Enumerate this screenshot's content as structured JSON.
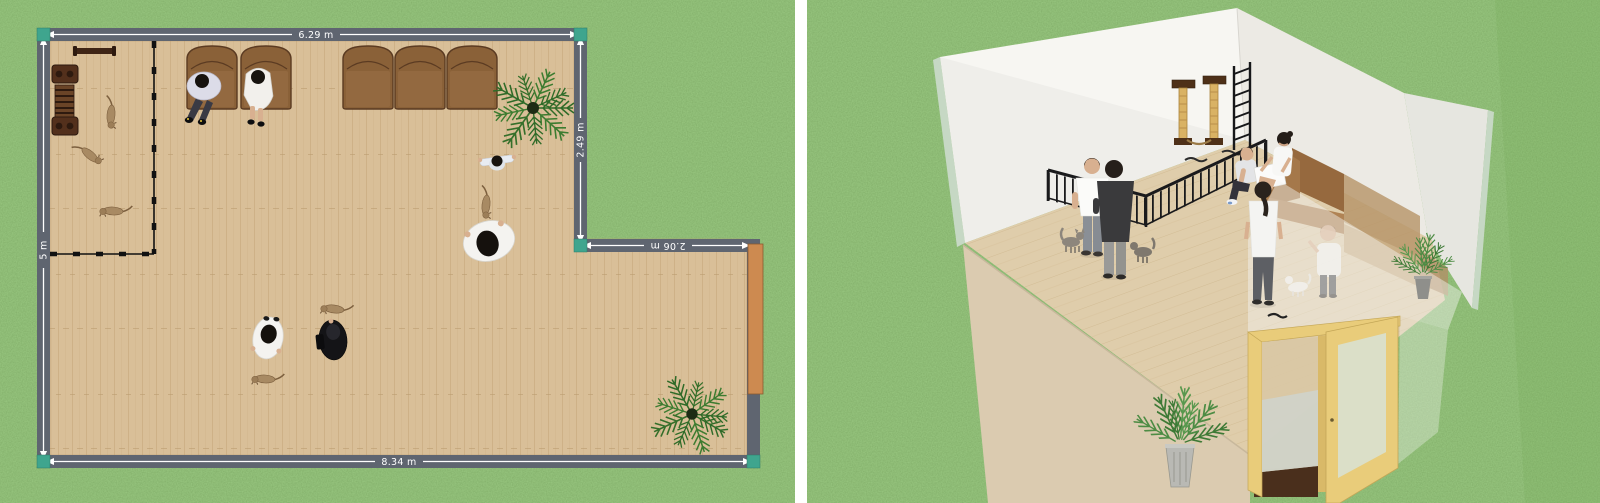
{
  "plan2d": {
    "dimensions": {
      "top": "6.29 m",
      "right": "2.49 m",
      "step": "2.06 m",
      "bottom": "8.34 m",
      "left": "5 m"
    }
  },
  "colors": {
    "grass": "#4e8a38",
    "divider": "#ffffff",
    "wall_band": "#5f6570",
    "dim_text": "#ffffff",
    "corner_accent": "#3fa58e",
    "floor": "#d9bf98",
    "plank_line": "#c9ab80",
    "sofa": "#8a6138",
    "sofa_seat": "#946a41",
    "sofa_outline": "#5b3b22",
    "fence": "#111111",
    "door_2d": "#cd8a50",
    "plant_green": "#2f6b28",
    "plant_center": "#1d2b14",
    "cat_fur": "#a88a63",
    "wall3d": "#f7f6f2",
    "wall3d_shade": "#eceae4",
    "wall3d_far": "#e6e6e0",
    "glass_edge": "#c6d8c4",
    "floor3d": "#dfcdab",
    "front_wall": "#dbcbb0",
    "door_frame": "#e9cc7a",
    "threshold": "#4a2f1c",
    "railing": "#1a1a1c",
    "cat_tree_post": "#d9b264",
    "platform": "#4e3018",
    "milk": "#f4f3f1"
  }
}
